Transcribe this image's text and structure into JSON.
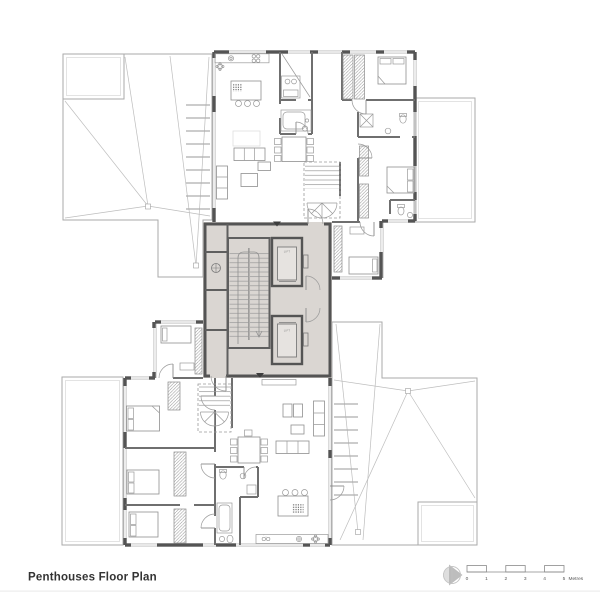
{
  "title": "Penthouses Floor Plan",
  "scalebar": {
    "labels": [
      "0",
      "1",
      "2",
      "3",
      "4",
      "5"
    ],
    "unit": "Metres"
  },
  "core": {
    "lift1_label": "LIFT",
    "lift2_label": "LIFT"
  },
  "icons": {
    "north": "north-indicator-icon"
  },
  "colors": {
    "wall": "#545454",
    "interior_wall": "#6f6f6f",
    "core_fill": "#dad6d2",
    "terrace_grid": "#d6d6d6",
    "terrace_outline": "#aaaaaa",
    "furniture": "#8f8f8f",
    "north_fill": "#b7b7b7",
    "title_text": "#333333"
  }
}
